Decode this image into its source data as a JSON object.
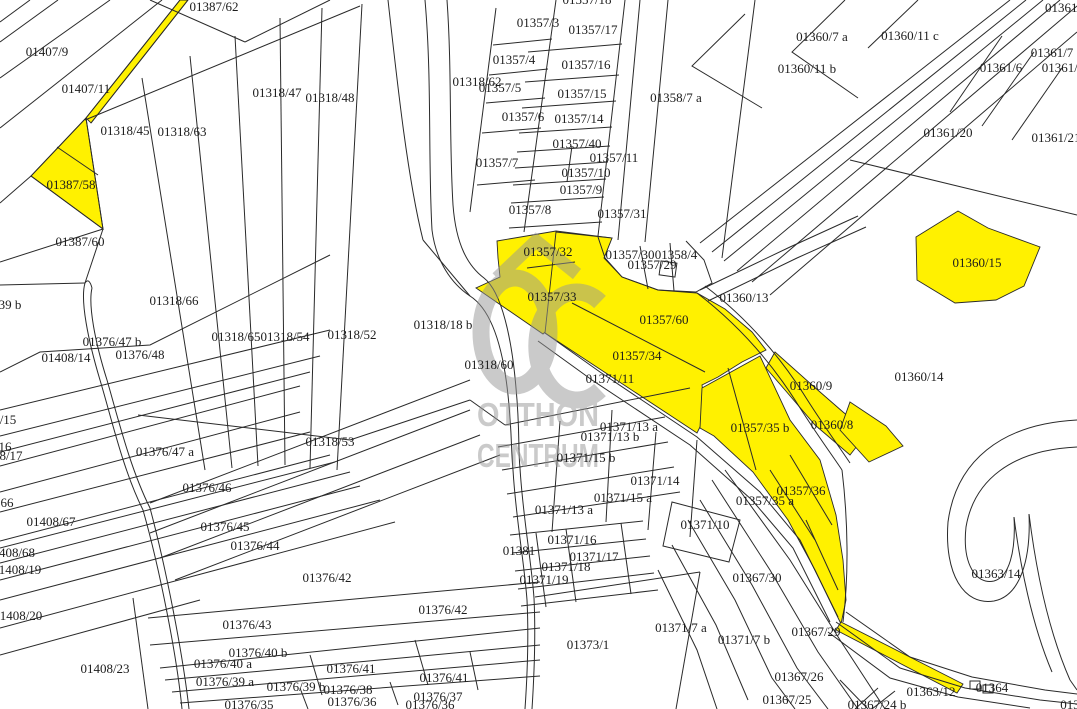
{
  "map": {
    "title": "cadastral-parcel-map",
    "colors": {
      "highlight": "#FFF100",
      "line": "#2a2a2a",
      "label": "#1c1c1c",
      "watermark": "#969696",
      "background": "#ffffff"
    },
    "watermark": {
      "logo": "OC",
      "line1": "OTTHON",
      "line2": "CENTRUM"
    },
    "labels": [
      {
        "t": "01387/62",
        "x": 214,
        "y": 7
      },
      {
        "t": "01407/9",
        "x": 47,
        "y": 52
      },
      {
        "t": "01407/11",
        "x": 86,
        "y": 89
      },
      {
        "t": "01318/45",
        "x": 125,
        "y": 131
      },
      {
        "t": "01318/63",
        "x": 182,
        "y": 132
      },
      {
        "t": "01318/47",
        "x": 277,
        "y": 93
      },
      {
        "t": "01318/48",
        "x": 330,
        "y": 98
      },
      {
        "t": "01387/58",
        "x": 71,
        "y": 185
      },
      {
        "t": "01387/60",
        "x": 80,
        "y": 242
      },
      {
        "t": "01318/66",
        "x": 174,
        "y": 301
      },
      {
        "t": "39 b",
        "x": 10,
        "y": 305
      },
      {
        "t": "01376/47 b",
        "x": 112,
        "y": 342
      },
      {
        "t": "01408/14",
        "x": 66,
        "y": 358
      },
      {
        "t": "01376/48",
        "x": 140,
        "y": 355
      },
      {
        "t": "01318/65",
        "x": 236,
        "y": 337
      },
      {
        "t": "01318/54",
        "x": 285,
        "y": 337
      },
      {
        "t": "01318/52",
        "x": 352,
        "y": 335
      },
      {
        "t": "01318/18 b",
        "x": 443,
        "y": 325
      },
      {
        "t": "01318/60",
        "x": 489,
        "y": 365
      },
      {
        "t": "/15",
        "x": 8,
        "y": 420
      },
      {
        "t": "16",
        "x": 5,
        "y": 447
      },
      {
        "t": "8/17",
        "x": 11,
        "y": 456
      },
      {
        "t": "01376/47 a",
        "x": 165,
        "y": 452
      },
      {
        "t": "01318/53",
        "x": 330,
        "y": 442
      },
      {
        "t": "01376/46",
        "x": 207,
        "y": 488
      },
      {
        "t": "66",
        "x": 7,
        "y": 503
      },
      {
        "t": "01408/67",
        "x": 51,
        "y": 522
      },
      {
        "t": "408/68",
        "x": 17,
        "y": 553
      },
      {
        "t": "1408/19",
        "x": 20,
        "y": 570
      },
      {
        "t": "01376/45",
        "x": 225,
        "y": 527
      },
      {
        "t": "01376/44",
        "x": 255,
        "y": 546
      },
      {
        "t": "1408/20",
        "x": 21,
        "y": 616
      },
      {
        "t": "01376/42",
        "x": 327,
        "y": 578
      },
      {
        "t": "01376/42",
        "x": 443,
        "y": 610
      },
      {
        "t": "01408/23",
        "x": 105,
        "y": 669
      },
      {
        "t": "01376/43",
        "x": 247,
        "y": 625
      },
      {
        "t": "01376/40 b",
        "x": 258,
        "y": 653
      },
      {
        "t": "01376/40 a",
        "x": 223,
        "y": 664
      },
      {
        "t": "01376/39 a",
        "x": 225,
        "y": 682
      },
      {
        "t": "01376/39 b",
        "x": 296,
        "y": 687
      },
      {
        "t": "01376/41",
        "x": 351,
        "y": 669
      },
      {
        "t": "01376/41",
        "x": 444,
        "y": 678
      },
      {
        "t": "01376/38",
        "x": 348,
        "y": 690
      },
      {
        "t": "01376/37",
        "x": 438,
        "y": 697
      },
      {
        "t": "01376/36",
        "x": 352,
        "y": 702
      },
      {
        "t": "01376/36",
        "x": 430,
        "y": 705
      },
      {
        "t": "01376/35",
        "x": 249,
        "y": 705
      },
      {
        "t": "01357/3",
        "x": 538,
        "y": 23
      },
      {
        "t": "01357/17",
        "x": 593,
        "y": 30
      },
      {
        "t": "01357/4",
        "x": 514,
        "y": 60
      },
      {
        "t": "01357/16",
        "x": 586,
        "y": 65
      },
      {
        "t": "01318/62",
        "x": 477,
        "y": 82
      },
      {
        "t": "01357/5",
        "x": 500,
        "y": 88
      },
      {
        "t": "01357/15",
        "x": 582,
        "y": 94
      },
      {
        "t": "01357/6",
        "x": 523,
        "y": 117
      },
      {
        "t": "01357/14",
        "x": 579,
        "y": 119
      },
      {
        "t": "01357/40",
        "x": 577,
        "y": 144
      },
      {
        "t": "01357/11",
        "x": 614,
        "y": 158
      },
      {
        "t": "01357/7",
        "x": 497,
        "y": 163
      },
      {
        "t": "01357/10",
        "x": 586,
        "y": 173
      },
      {
        "t": "01357/9",
        "x": 581,
        "y": 190
      },
      {
        "t": "01357/8",
        "x": 530,
        "y": 210
      },
      {
        "t": "01357/31",
        "x": 622,
        "y": 214
      },
      {
        "t": "01358/7 a",
        "x": 676,
        "y": 98
      },
      {
        "t": "01357/18",
        "x": 587,
        "y": 0
      },
      {
        "t": "01357/32",
        "x": 548,
        "y": 252
      },
      {
        "t": "01357/30",
        "x": 630,
        "y": 255
      },
      {
        "t": "01358/4",
        "x": 676,
        "y": 255
      },
      {
        "t": "01357/29",
        "x": 652,
        "y": 265
      },
      {
        "t": "01357/33",
        "x": 552,
        "y": 297
      },
      {
        "t": "01357/60",
        "x": 664,
        "y": 320
      },
      {
        "t": "01360/13",
        "x": 744,
        "y": 298
      },
      {
        "t": "01357/34",
        "x": 637,
        "y": 356
      },
      {
        "t": "01371/11",
        "x": 610,
        "y": 379
      },
      {
        "t": "01360/9",
        "x": 811,
        "y": 386
      },
      {
        "t": "01360/8",
        "x": 832,
        "y": 425
      },
      {
        "t": "01357/35 b",
        "x": 760,
        "y": 428
      },
      {
        "t": "01360/14",
        "x": 919,
        "y": 377
      },
      {
        "t": "01360/15",
        "x": 977,
        "y": 263
      },
      {
        "t": "01357/36",
        "x": 801,
        "y": 491
      },
      {
        "t": "01357/35 a",
        "x": 765,
        "y": 501
      },
      {
        "t": "01360/7 a",
        "x": 822,
        "y": 37
      },
      {
        "t": "01360/11 c",
        "x": 910,
        "y": 36
      },
      {
        "t": "01360/11 b",
        "x": 807,
        "y": 69
      },
      {
        "t": "01361/6",
        "x": 1001,
        "y": 68
      },
      {
        "t": "01361/7",
        "x": 1052,
        "y": 53
      },
      {
        "t": "01361/2",
        "x": 1063,
        "y": 68
      },
      {
        "t": "01361/",
        "x": 1063,
        "y": 8
      },
      {
        "t": "01361/20",
        "x": 948,
        "y": 133
      },
      {
        "t": "01361/21",
        "x": 1056,
        "y": 138
      },
      {
        "t": "01371/13 a",
        "x": 629,
        "y": 427
      },
      {
        "t": "01371/13 b",
        "x": 610,
        "y": 437
      },
      {
        "t": "01371/15 b",
        "x": 586,
        "y": 458
      },
      {
        "t": "01371/14",
        "x": 655,
        "y": 481
      },
      {
        "t": "01371/15 a",
        "x": 623,
        "y": 498
      },
      {
        "t": "01371/13 a",
        "x": 564,
        "y": 510
      },
      {
        "t": "01371/10",
        "x": 705,
        "y": 525
      },
      {
        "t": "01371/16",
        "x": 572,
        "y": 540
      },
      {
        "t": "01381",
        "x": 519,
        "y": 551
      },
      {
        "t": "01371/17",
        "x": 594,
        "y": 557
      },
      {
        "t": "01371/18",
        "x": 566,
        "y": 567
      },
      {
        "t": "01371/19",
        "x": 544,
        "y": 580
      },
      {
        "t": "01373/1",
        "x": 588,
        "y": 645
      },
      {
        "t": "01371/7 a",
        "x": 681,
        "y": 628
      },
      {
        "t": "01371/7 b",
        "x": 744,
        "y": 640
      },
      {
        "t": "01367/30",
        "x": 757,
        "y": 578
      },
      {
        "t": "01363/14",
        "x": 996,
        "y": 574
      },
      {
        "t": "01367/29",
        "x": 816,
        "y": 632
      },
      {
        "t": "01367/26",
        "x": 799,
        "y": 677
      },
      {
        "t": "01367/25",
        "x": 787,
        "y": 700
      },
      {
        "t": "01363/12",
        "x": 931,
        "y": 692
      },
      {
        "t": "01364",
        "x": 992,
        "y": 688
      },
      {
        "t": "01367/24 b",
        "x": 877,
        "y": 705
      },
      {
        "t": "013",
        "x": 1070,
        "y": 705
      }
    ]
  }
}
